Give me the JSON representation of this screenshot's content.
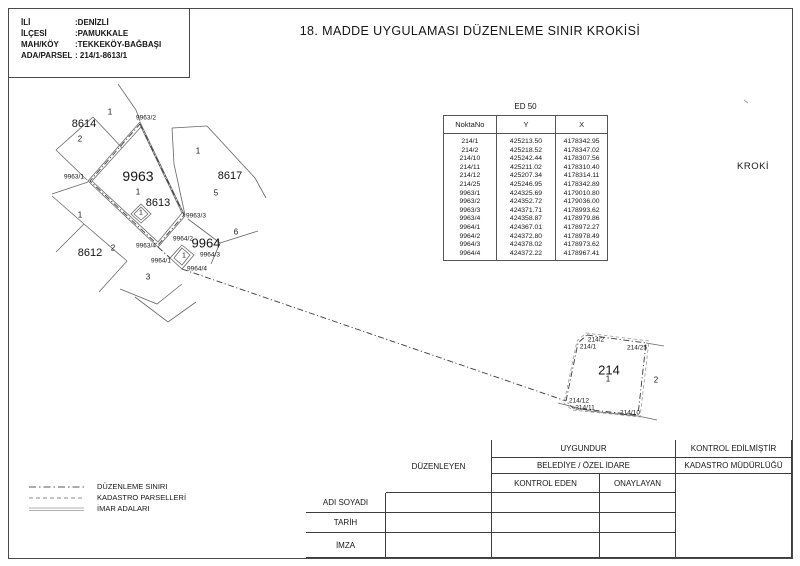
{
  "header": {
    "info": [
      {
        "label": "İLİ",
        "value": ":DENİZLİ"
      },
      {
        "label": "İLÇESİ",
        "value": ":PAMUKKALE"
      },
      {
        "label": "MAH/KÖY",
        "value": ":TEKKEKÖY-BAĞBAŞI"
      },
      {
        "label": "ADA/PARSEL",
        "value": ": 214/1-8613/1"
      }
    ],
    "title": "18. MADDE UYGULAMASI DÜZENLEME SINIR KROKİSİ"
  },
  "kroki_label": "KROKİ",
  "coord_table": {
    "title": "ED 50",
    "columns": [
      "NoktaNo",
      "Y",
      "X"
    ],
    "rows": [
      [
        "214/1",
        "425213.50",
        "4178342.95"
      ],
      [
        "214/2",
        "425218.52",
        "4178347.02"
      ],
      [
        "214/10",
        "425242.44",
        "4178307.56"
      ],
      [
        "214/11",
        "425211.02",
        "4178310.40"
      ],
      [
        "214/12",
        "425207.34",
        "4178314.11"
      ],
      [
        "214/25",
        "425246.95",
        "4178342.89"
      ],
      [
        "9963/1",
        "424325.69",
        "4179010.80"
      ],
      [
        "9963/2",
        "424352.72",
        "4179036.00"
      ],
      [
        "9963/3",
        "424371.71",
        "4178993.62"
      ],
      [
        "9963/4",
        "424358.87",
        "4178979.86"
      ],
      [
        "9964/1",
        "424367.01",
        "4178972.27"
      ],
      [
        "9964/2",
        "424372.80",
        "4178978.49"
      ],
      [
        "9964/3",
        "424378.02",
        "4178973.62"
      ],
      [
        "9964/4",
        "424372.22",
        "4178967.41"
      ]
    ]
  },
  "map_labels": [
    {
      "text": "8614",
      "x": 84,
      "y": 124,
      "size": 11
    },
    {
      "text": "1",
      "x": 110,
      "y": 112,
      "size": 8
    },
    {
      "text": "2",
      "x": 80,
      "y": 139,
      "size": 8
    },
    {
      "text": "9963/2",
      "x": 146,
      "y": 118,
      "size": 6.5
    },
    {
      "text": "9963/1",
      "x": 74,
      "y": 177,
      "size": 6.5
    },
    {
      "text": "9963",
      "x": 138,
      "y": 176,
      "size": 14
    },
    {
      "text": "1",
      "x": 138,
      "y": 192,
      "size": 8
    },
    {
      "text": "8613",
      "x": 158,
      "y": 203,
      "size": 11
    },
    {
      "text": "1",
      "x": 141,
      "y": 213,
      "size": 7
    },
    {
      "text": "8617",
      "x": 230,
      "y": 176,
      "size": 11
    },
    {
      "text": "1",
      "x": 198,
      "y": 151,
      "size": 8
    },
    {
      "text": "5",
      "x": 216,
      "y": 193,
      "size": 8
    },
    {
      "text": "6",
      "x": 236,
      "y": 232,
      "size": 8
    },
    {
      "text": "9963/3",
      "x": 196,
      "y": 216,
      "size": 6.5
    },
    {
      "text": "9963/4",
      "x": 146,
      "y": 246,
      "size": 6.5
    },
    {
      "text": "9964/2",
      "x": 183,
      "y": 239,
      "size": 6.5
    },
    {
      "text": "9964",
      "x": 206,
      "y": 243,
      "size": 13
    },
    {
      "text": "9964/1",
      "x": 161,
      "y": 261,
      "size": 6.5
    },
    {
      "text": "1",
      "x": 184,
      "y": 256,
      "size": 7
    },
    {
      "text": "9964/3",
      "x": 210,
      "y": 255,
      "size": 6.5
    },
    {
      "text": "9964/4",
      "x": 197,
      "y": 269,
      "size": 6.5
    },
    {
      "text": "8612",
      "x": 90,
      "y": 253,
      "size": 11
    },
    {
      "text": "1",
      "x": 80,
      "y": 215,
      "size": 8
    },
    {
      "text": "2",
      "x": 113,
      "y": 248,
      "size": 8
    },
    {
      "text": "3",
      "x": 148,
      "y": 277,
      "size": 8
    },
    {
      "text": "214/2",
      "x": 596,
      "y": 340,
      "size": 6.5
    },
    {
      "text": "214/1",
      "x": 588,
      "y": 347,
      "size": 6.5
    },
    {
      "text": "214/25",
      "x": 637,
      "y": 348,
      "size": 6.5
    },
    {
      "text": "214",
      "x": 609,
      "y": 370,
      "size": 13
    },
    {
      "text": "1",
      "x": 608,
      "y": 379,
      "size": 8
    },
    {
      "text": "2",
      "x": 656,
      "y": 380,
      "size": 8
    },
    {
      "text": "214/12",
      "x": 579,
      "y": 401,
      "size": 6.5
    },
    {
      "text": "214/11",
      "x": 585,
      "y": 408,
      "size": 6.5
    },
    {
      "text": "214/10",
      "x": 630,
      "y": 413,
      "size": 6.5
    }
  ],
  "legend": {
    "items": [
      {
        "style": "dashdot",
        "label": "DÜZENLEME SINIRI"
      },
      {
        "style": "dashed",
        "label": "KADASTRO PARSELLERİ"
      },
      {
        "style": "solid",
        "label": "İMAR ADALARI"
      }
    ]
  },
  "approval_table": {
    "duzenleyen": "DÜZENLEYEN",
    "uygundur": "UYGUNDUR",
    "belediye": "BELEDİYE / ÖZEL İDARE",
    "kontrol_eden": "KONTROL EDEN",
    "onaylayan": "ONAYLAYAN",
    "kontrol_edilmistir": "KONTROL EDİLMİŞTİR",
    "kadastro_mudurlugu": "KADASTRO MÜDÜRLÜĞÜ",
    "rows": [
      "ADI SOYADI",
      "TARİH",
      "İMZA"
    ]
  },
  "colors": {
    "page_border": "#4a4a4a",
    "cadastral_line": "#666666",
    "boundary_line": "#333333",
    "dashed_line": "#999999",
    "text": "#161616"
  }
}
